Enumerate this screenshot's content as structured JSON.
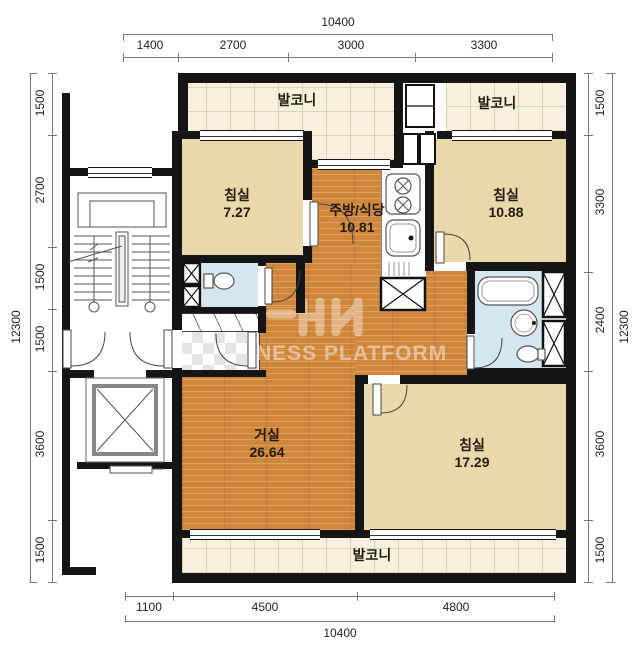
{
  "title": "apartment-unit-floor-plan",
  "dimensions": {
    "top": {
      "overall": "10400",
      "segments": [
        "1400",
        "2700",
        "3000",
        "3300"
      ]
    },
    "bottom": {
      "overall": "10400",
      "segments": [
        "1100",
        "4500",
        "4800"
      ]
    },
    "left": {
      "overall": "12300",
      "segments": [
        "1500",
        "2700",
        "1500",
        "1500",
        "3600",
        "1500"
      ]
    },
    "right": {
      "overall": "12300",
      "segments": [
        "1500",
        "3300",
        "2400",
        "3600",
        "1500"
      ]
    }
  },
  "rooms": {
    "balcony_top_left": {
      "label": "발코니"
    },
    "balcony_top_right": {
      "label": "발코니"
    },
    "balcony_bottom": {
      "label": "발코니"
    },
    "bedroom_small": {
      "label": "침실",
      "area": "7.27"
    },
    "kitchen_dining": {
      "label": "주방/식당",
      "area": "10.81"
    },
    "bedroom_right": {
      "label": "침실",
      "area": "10.88"
    },
    "living_room": {
      "label": "거실",
      "area": "26.64"
    },
    "bedroom_master": {
      "label": "침실",
      "area": "17.29"
    }
  },
  "watermark": {
    "text": "NESS PLATFORM"
  },
  "colors": {
    "wall": "#151515",
    "wood_floor": "#d0873c",
    "bedroom_floor": "#e9d8a9",
    "balcony_tile": "#f8efdc",
    "bathroom_floor": "#d4e6ef",
    "dimension_text": "#222222"
  }
}
